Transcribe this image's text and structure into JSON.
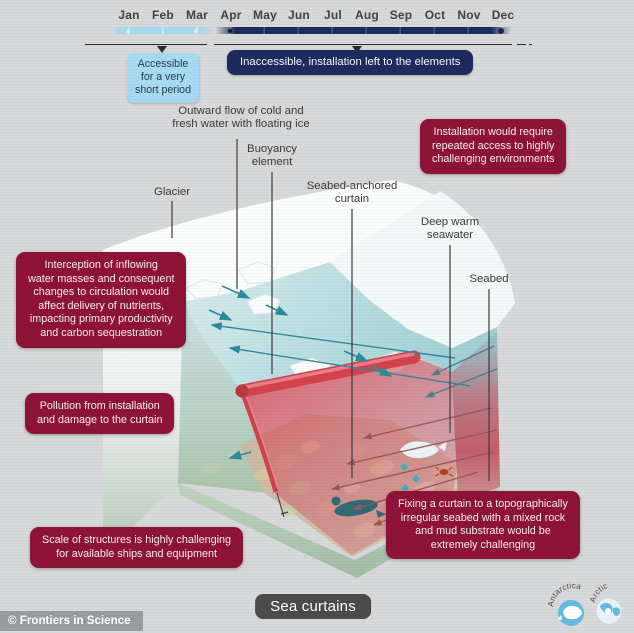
{
  "timeline": {
    "months": [
      "Jan",
      "Feb",
      "Mar",
      "Apr",
      "May",
      "Jun",
      "Jul",
      "Aug",
      "Sep",
      "Oct",
      "Nov",
      "Dec"
    ],
    "accessible_label": "Accessible\nfor a very\nshort period",
    "inaccessible_label": "Inaccessible, installation left to the elements"
  },
  "labels": {
    "outward_flow": "Outward flow of cold and\nfresh water with floating ice",
    "buoyancy": "Buoyancy\nelement",
    "glacier": "Glacier",
    "curtain": "Seabed-anchored\ncurtain",
    "deep_warm": "Deep warm\nseawater",
    "seabed": "Seabed"
  },
  "callouts": {
    "installation": "Installation would require\nrepeated access to highly\nchallenging environments",
    "interception": "Interception of inflowing\nwater masses and consequent\nchanges to circulation would\naffect delivery of nutrients,\nimpacting primary productivity\nand carbon sequestration",
    "pollution": "Pollution from installation\nand damage to the curtain",
    "scale": "Scale of structures is highly challenging\nfor available ships and equipment",
    "fixing": "Fixing a curtain to a topographically\nirregular seabed with a mixed rock\nand mud substrate would be\nextremely challenging"
  },
  "footer": {
    "title": "Sea curtains",
    "credit": "© Frontiers in Science",
    "icons": [
      {
        "label": "Antarctica"
      },
      {
        "label": "Arctic"
      }
    ]
  },
  "colors": {
    "callout_red": "#8e1437",
    "navy": "#1c2c5e",
    "light_blue": "#a8daf2",
    "curtain_red": "#d2434e",
    "water_teal": "#a2d3d9",
    "seabed_green": "#a9c3a8",
    "arrow_teal": "#2c8aa0",
    "arrow_warm": "#9a5560",
    "footer_gray": "#4b4b4a"
  }
}
